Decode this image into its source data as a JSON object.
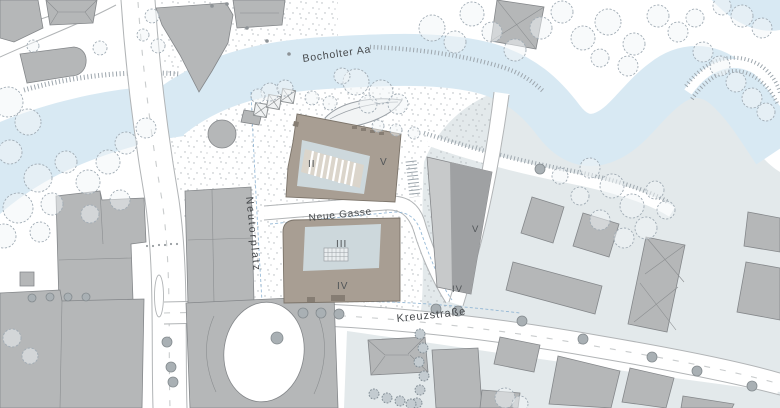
{
  "map": {
    "labels": {
      "river": "Bocholter Aa",
      "street_neue_gasse": "Neue Gasse",
      "square_neutorplatz": "Neutorplatz",
      "street_kreuzstrasse": "Kreuzstraße",
      "bldg_ii": "II",
      "bldg_v_center": "V",
      "bldg_iii": "III",
      "bldg_iv_center": "IV",
      "bldg_v_east": "V",
      "bldg_iv_east": "IV"
    },
    "colors": {
      "water": "#d8e9f3",
      "ground": "#e3e9eb",
      "building": "#b5b7b8",
      "building_dark": "#9fa1a3",
      "building_light": "#c7c9ca",
      "new_building": "#a89e93",
      "courtyard": "#cdd8dc",
      "ramp": "#dbd5cb",
      "channel": "#85aed0"
    }
  }
}
